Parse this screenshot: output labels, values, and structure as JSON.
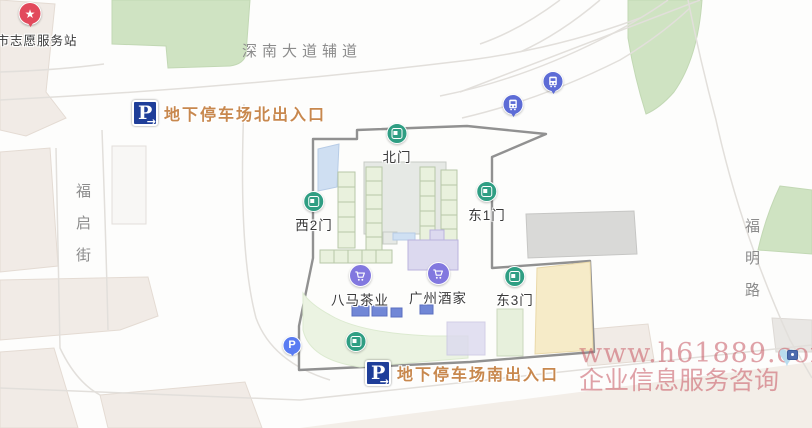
{
  "map": {
    "streets": {
      "top": "深南大道辅道",
      "left": "福启街",
      "right": "福明路"
    },
    "parking": {
      "north_label": "地下停车场北出入口",
      "south_label": "地下停车场南出入口"
    },
    "gates": [
      {
        "label": "北门"
      },
      {
        "label": "西2门"
      },
      {
        "label": "东1门"
      },
      {
        "label": "东3门"
      }
    ],
    "shops": [
      {
        "label": "八马茶业"
      },
      {
        "label": "广州酒家"
      }
    ],
    "volunteer": {
      "label": "市志愿服务站"
    },
    "watermark": {
      "line1": "www.h61889.com",
      "line2": "企业信息服务咨询"
    },
    "glyphs": {
      "parking_letter": "P",
      "arrow_right": "→",
      "star": "★",
      "heart": "♥"
    },
    "icons": {
      "gate": "gate-icon",
      "shop": "shopping-cart-icon",
      "bus_stop": "bus-stop-icon",
      "parking_entrance": "parking-p-arrow-icon",
      "parking_lot": "parking-p-circle-icon",
      "volunteer_station": "star-pin-icon",
      "watermark": "heart-icon"
    },
    "colors": {
      "gate_green": "#2f9e83",
      "shop_purple": "#8278df",
      "bus_blue": "#5d6cd6",
      "parking_navy": "#1f3e99",
      "parking_lot_blue": "#5a7cf2",
      "pin_red": "#e2495c",
      "entrance_label_orange": "#c8884e",
      "street_label_gray": "#8c8c8c",
      "watermark_pink": "#c85660",
      "park_green": "#cfe3c2",
      "courtyard_yellow": "#f6ebc8"
    }
  }
}
